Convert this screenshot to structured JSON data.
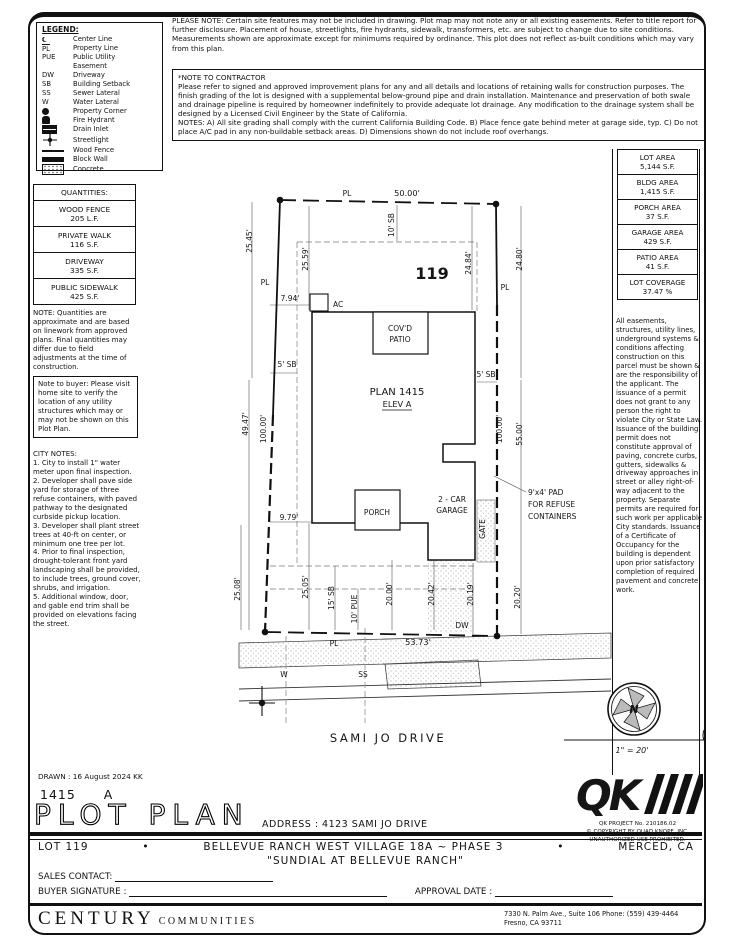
{
  "legend": {
    "title": "LEGEND:",
    "items": [
      {
        "symbol": "℄",
        "label": "Center Line"
      },
      {
        "symbol": "PL",
        "label": "Property Line"
      },
      {
        "symbol": "PUE",
        "label": "Public Utility Easement"
      },
      {
        "symbol": "DW",
        "label": "Driveway"
      },
      {
        "symbol": "SB",
        "label": "Building Setback"
      },
      {
        "symbol": "SS",
        "label": "Sewer Lateral"
      },
      {
        "symbol": "W",
        "label": "Water Lateral"
      },
      {
        "icon": "property-corner-icon",
        "label": "Property Corner"
      },
      {
        "icon": "fire-hydrant-icon",
        "label": "Fire Hydrant"
      },
      {
        "icon": "drain-inlet-icon",
        "label": "Drain Inlet"
      },
      {
        "icon": "streetlight-icon",
        "label": "Streetlight"
      },
      {
        "icon": "wood-fence-icon",
        "label": "Wood Fence"
      },
      {
        "icon": "block-wall-icon",
        "label": "Block Wall"
      },
      {
        "icon": "concrete-icon",
        "label": "Concrete"
      }
    ]
  },
  "notes": {
    "please_note": "PLEASE NOTE:  Certain site features may not be included in drawing. Plot map may not note any or all existing easements. Refer to title report for further disclosure. Placement of house, streetlights, fire hydrants, sidewalk, transformers, etc. are subject to change due to site conditions. Measurements shown are approximate except for minimums required by ordinance. This plot does not reflect as-built conditions which may vary from this plan.",
    "contractor_title": "*NOTE TO CONTRACTOR",
    "contractor_body": "Please refer to signed and approved improvement plans for any and all details and locations of retaining walls for construction purposes. The finish grading of the lot is designed with a supplemental below-ground pipe and drain installation. Maintenance and preservation of both swale and drainage pipeline is required by homeowner indefinitely to provide adequate lot drainage. Any modification to the drainage system shall be designed by a Licensed Civil Engineer by the State of California.",
    "contractor_notes": "NOTES:  A) All site grading shall comply with the current California Building Code.  B) Place fence gate behind meter at garage side, typ. C) Do not place A/C pad in any non-buildable setback areas.  D) Dimensions shown do not include roof overhangs.",
    "quantities_note": "NOTE: Quantities are approximate and are based on linework from approved plans.  Final quantities may differ due to field adjustments at the time of construction.",
    "buyer_note": "Note to buyer: Please visit home site to verify the location of any utility structures which may or may not be shown on this Plot Plan.",
    "city_notes_title": "CITY NOTES:",
    "city_notes_body": "1. City to install 1\" water meter upon final inspection.\n2. Developer shall pave side yard for storage of three refuse containers, with paved pathway to the designated curbside pickup location.\n3. Developer shall plant street trees at 40-ft on center, or minimum one tree per lot.\n4. Prior to final inspection, drought-tolerant front yard landscaping shall be provided, to include trees, ground cover, shrubs, and irrigation.\n5. Additional window, door, and gable end trim shall be provided on elevations facing the street.",
    "easement_note": "All easements, structures, utility lines, underground systems & conditions affecting construction on this parcel must be shown & are the responsibility of the applicant. The issuance of a permit does not grant to any person the right to violate City or State Law.\nIssuance of the building permit does not constitute approval of paving, concrete curbs, gutters, sidewalks & driveway approaches in street or alley right-of-way adjacent to the property. Separate permits are required for such work per applicable City standards. Issuance of a Certificate of Occupancy for the building is dependent upon prior satisfactory completion of required pavement and concrete work."
  },
  "quantities": {
    "title": "QUANTITIES:",
    "items": [
      {
        "name": "WOOD FENCE",
        "value": "205 L.F."
      },
      {
        "name": "PRIVATE WALK",
        "value": "116 S.F."
      },
      {
        "name": "DRIVEWAY",
        "value": "335 S.F."
      },
      {
        "name": "PUBLIC SIDEWALK",
        "value": "425 S.F."
      }
    ]
  },
  "areas": {
    "items": [
      {
        "label": "LOT AREA",
        "value": "5,144 S.F."
      },
      {
        "label": "BLDG AREA",
        "value": "1,415 S.F."
      },
      {
        "label": "PORCH AREA",
        "value": "37 S.F."
      },
      {
        "label": "GARAGE AREA",
        "value": "429 S.F."
      },
      {
        "label": "PATIO AREA",
        "value": "41 S.F."
      },
      {
        "label": "LOT COVERAGE",
        "value": "37.47 %"
      }
    ]
  },
  "drawing": {
    "lot_number": "119",
    "plan": "PLAN 1415",
    "elev": "ELEV A",
    "covd_1": "COV'D",
    "covd_2": "PATIO",
    "ac": "AC",
    "porch": "PORCH",
    "garage_1": "2 - CAR",
    "garage_2": "GARAGE",
    "gate": "GATE",
    "refuse_1": "9'x4' PAD",
    "refuse_2": "FOR REFUSE",
    "refuse_3": "CONTAINERS",
    "street": "SAMI JO DRIVE",
    "pl": "PL",
    "dw": "DW",
    "w": "W",
    "ss": "SS",
    "dims": {
      "top": "50.00'",
      "sb10": "10' SB",
      "d2545": "25.45'",
      "d2559": "25.59'",
      "d2484": "24.84'",
      "d2480": "24.80'",
      "d794": "7.94'",
      "sb5": "5' SB",
      "d4947": "49.47'",
      "d100": "100.00'",
      "d5500": "55.00'",
      "d979": "9.79'",
      "d2508": "25.08'",
      "d2505": "25.05'",
      "sb15": "15' SB",
      "pue10": "10' PUE",
      "d2000": "20.00'",
      "d2042": "20.42'",
      "d2019": "20.19'",
      "d2020": "20.20'",
      "d5373": "53.73'"
    }
  },
  "compass": {
    "north": "N",
    "scale": "1\" = 20'"
  },
  "qk": {
    "logo": "QK",
    "project": "QK PROJECT No. 210186.02",
    "copyright": "© COPYRIGHT BY QUAD KNOPF, INC.",
    "unauthorized": "UNAUTHORIZED USE PROHIBITED."
  },
  "title_block": {
    "drawn": "DRAWN : 16 August 2024  KK",
    "plan_num": "1415",
    "plan_elev": "A",
    "title": "PLOT PLAN",
    "address": "ADDRESS :  4123 SAMI JO DRIVE",
    "lot": "LOT 119",
    "bullet": "•",
    "subdivision": "BELLEVUE RANCH WEST VILLAGE 18A ~ PHASE 3",
    "city": "MERCED, CA",
    "community": "\"SUNDIAL AT BELLEVUE RANCH\"",
    "sales_label": "SALES CONTACT:",
    "buyer_label": "BUYER SIGNATURE :",
    "approval_label": "APPROVAL DATE :"
  },
  "footer": {
    "brand_1": "CENTURY",
    "brand_2": "COMMUNITIES",
    "address_1": "7330 N. Palm Ave., Suite 106    Phone:  (559) 439-4464",
    "address_2": "Fresno, CA  93711"
  }
}
